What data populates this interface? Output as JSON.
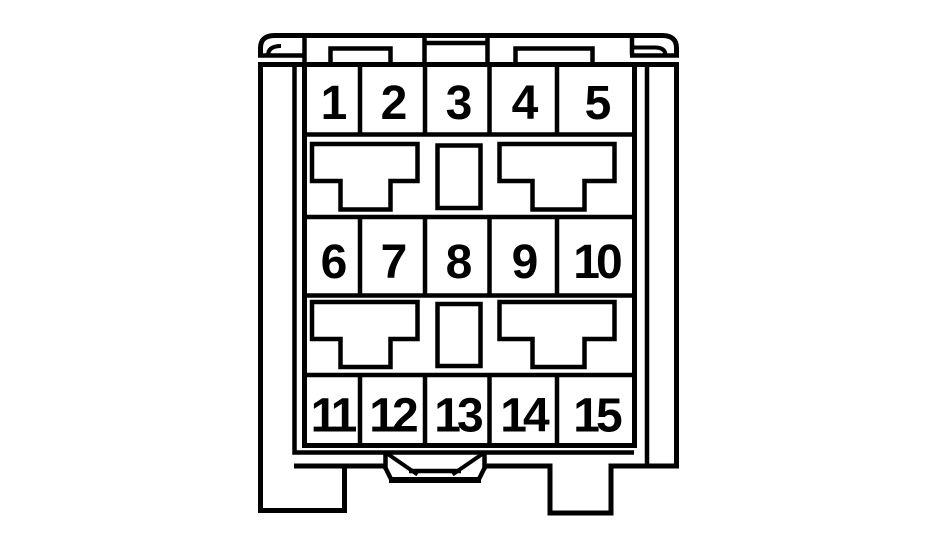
{
  "pins": [
    "1",
    "2",
    "3",
    "4",
    "5",
    "6",
    "7",
    "8",
    "9",
    "10",
    "11",
    "12",
    "13",
    "14",
    "15"
  ],
  "colors": {
    "line": "#000000",
    "background": "#ffffff"
  }
}
